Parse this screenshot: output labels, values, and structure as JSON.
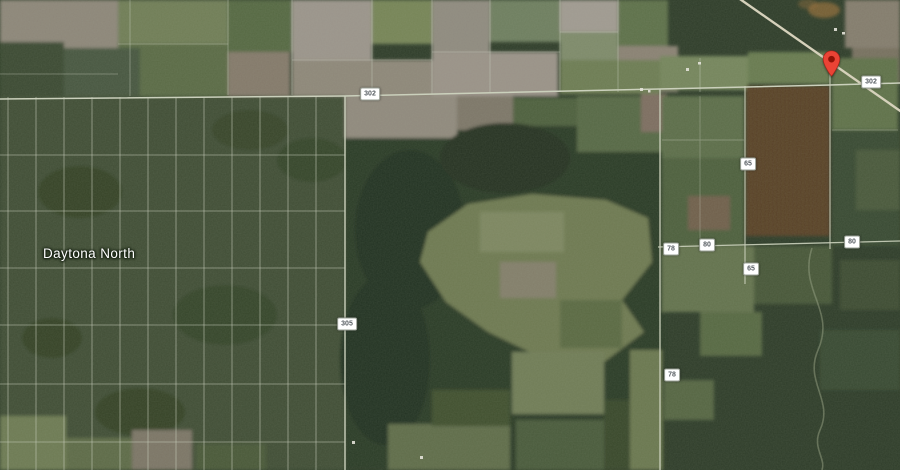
{
  "map": {
    "view_type": "satellite",
    "area_name": "Daytona North",
    "place_labels": [
      {
        "text": "Daytona North",
        "x": 43,
        "y": 246
      }
    ],
    "route_shields": [
      {
        "text": "302",
        "x": 370,
        "y": 94
      },
      {
        "text": "302",
        "x": 871,
        "y": 82
      },
      {
        "text": "305",
        "x": 347,
        "y": 324
      },
      {
        "text": "65",
        "x": 748,
        "y": 164
      },
      {
        "text": "80",
        "x": 707,
        "y": 245
      },
      {
        "text": "78",
        "x": 671,
        "y": 249
      },
      {
        "text": "65",
        "x": 751,
        "y": 269
      },
      {
        "text": "80",
        "x": 852,
        "y": 242
      },
      {
        "text": "78",
        "x": 672,
        "y": 375
      }
    ],
    "marker": {
      "x": 831,
      "y": 77,
      "color": "#EA4335",
      "dot_color": "#8E1206"
    },
    "colors": {
      "forest_dark": "#2c3a26",
      "forest_mid": "#3f4d35",
      "field_gray": "#8f887c",
      "field_green": "#6e7c54",
      "road_light": "#ccd1bd",
      "shield_bg": "#FFFFFF",
      "shield_text": "#565C61",
      "label_text": "#FFFFFF"
    }
  }
}
